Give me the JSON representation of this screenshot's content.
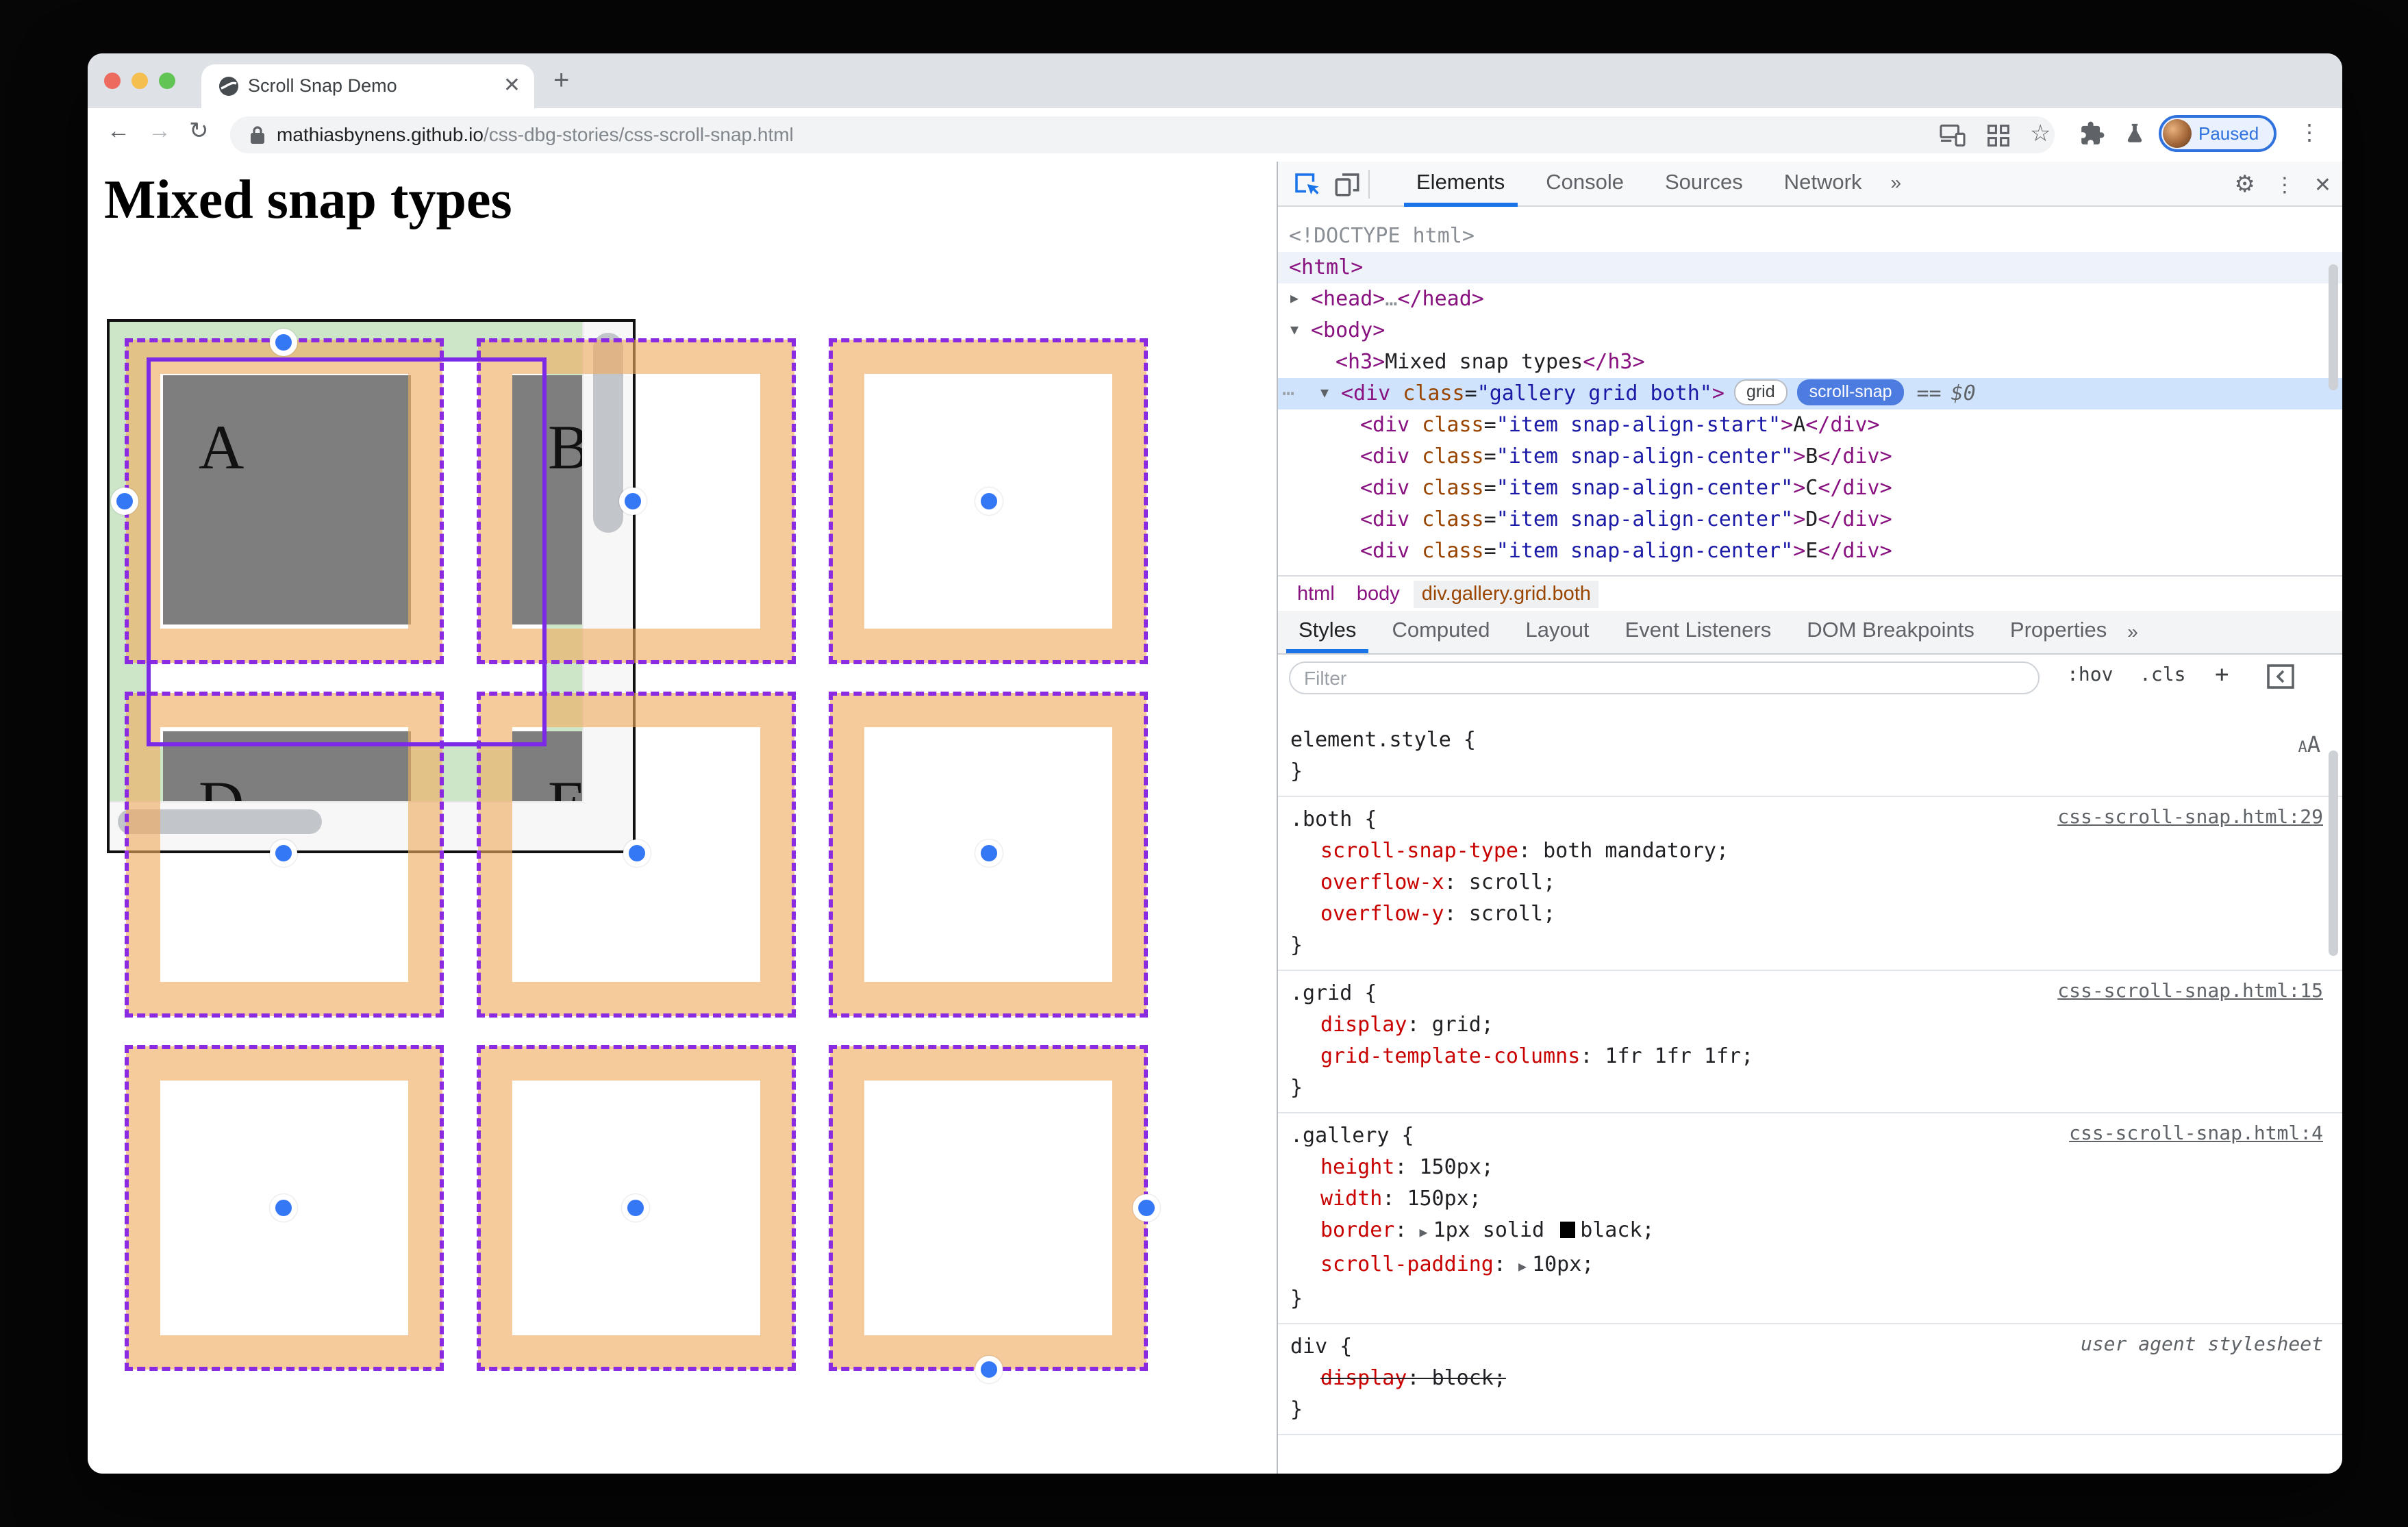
{
  "browser": {
    "tab_title": "Scroll Snap Demo",
    "new_tab_label": "+",
    "url": {
      "host": "mathiasbynens.github.io",
      "path": "/css-dbg-stories/css-scroll-snap.html"
    },
    "profile_badge": "Paused",
    "kebab": "⋮"
  },
  "page": {
    "heading": "Mixed snap types",
    "gallery_letters": [
      "A",
      "B",
      "D",
      "E"
    ]
  },
  "devtools": {
    "main_tabs": [
      "Elements",
      "Console",
      "Sources",
      "Network"
    ],
    "more_tabs_icon": "»",
    "gear_icon": "⚙",
    "kebab_icon": "⋮",
    "close_icon": "✕",
    "dom": {
      "lines": [
        {
          "ind": 8,
          "toks": [
            [
              "m",
              "<!DOCTYPE html>"
            ]
          ]
        },
        {
          "ind": 8,
          "soft": true,
          "toks": [
            [
              "t",
              "<html>"
            ]
          ]
        },
        {
          "ind": 24,
          "arrow": "▶",
          "toks": [
            [
              "t",
              "<head>"
            ],
            [
              "m",
              "…"
            ],
            [
              "t",
              "</head>"
            ]
          ]
        },
        {
          "ind": 24,
          "arrow": "▼",
          "toks": [
            [
              "t",
              "<body>"
            ]
          ]
        },
        {
          "ind": 42,
          "toks": [
            [
              "t",
              "<h3>"
            ],
            [
              "x",
              "Mixed snap types"
            ],
            [
              "t",
              "</h3>"
            ]
          ]
        },
        {
          "ind": 46,
          "arrow": "▼",
          "sel": true,
          "dots": "⋯",
          "badged": true,
          "toks": [
            [
              "t",
              "<div"
            ],
            [
              "a",
              " class"
            ],
            [
              "p",
              "="
            ],
            [
              "v",
              "\"gallery grid both\""
            ],
            [
              "t",
              ">"
            ]
          ]
        },
        {
          "ind": 60,
          "toks": [
            [
              "t",
              "<div"
            ],
            [
              "a",
              " class"
            ],
            [
              "p",
              "="
            ],
            [
              "v",
              "\"item snap-align-start\""
            ],
            [
              "t",
              ">"
            ],
            [
              "x",
              "A"
            ],
            [
              "t",
              "</div>"
            ]
          ]
        },
        {
          "ind": 60,
          "toks": [
            [
              "t",
              "<div"
            ],
            [
              "a",
              " class"
            ],
            [
              "p",
              "="
            ],
            [
              "v",
              "\"item snap-align-center\""
            ],
            [
              "t",
              ">"
            ],
            [
              "x",
              "B"
            ],
            [
              "t",
              "</div>"
            ]
          ]
        },
        {
          "ind": 60,
          "toks": [
            [
              "t",
              "<div"
            ],
            [
              "a",
              " class"
            ],
            [
              "p",
              "="
            ],
            [
              "v",
              "\"item snap-align-center\""
            ],
            [
              "t",
              ">"
            ],
            [
              "x",
              "C"
            ],
            [
              "t",
              "</div>"
            ]
          ]
        },
        {
          "ind": 60,
          "toks": [
            [
              "t",
              "<div"
            ],
            [
              "a",
              " class"
            ],
            [
              "p",
              "="
            ],
            [
              "v",
              "\"item snap-align-center\""
            ],
            [
              "t",
              ">"
            ],
            [
              "x",
              "D"
            ],
            [
              "t",
              "</div>"
            ]
          ]
        },
        {
          "ind": 60,
          "toks": [
            [
              "t",
              "<div"
            ],
            [
              "a",
              " class"
            ],
            [
              "p",
              "="
            ],
            [
              "v",
              "\"item snap-align-center\""
            ],
            [
              "t",
              ">"
            ],
            [
              "x",
              "E"
            ],
            [
              "t",
              "</div>"
            ]
          ]
        }
      ],
      "badges": [
        "grid",
        "scroll-snap"
      ],
      "suffix_eq": "==",
      "suffix_var": "$0"
    },
    "breadcrumb": [
      "html",
      "body",
      "div.gallery.grid.both"
    ],
    "styles_tabs": [
      "Styles",
      "Computed",
      "Layout",
      "Event Listeners",
      "DOM Breakpoints",
      "Properties"
    ],
    "filter_placeholder": "Filter",
    "hov_label": ":hov",
    "cls_label": ".cls",
    "add_label": "+",
    "font_size_label": "AA",
    "rules": [
      {
        "selector": "element.style",
        "link": "",
        "props": [],
        "aa": true
      },
      {
        "selector": ".both",
        "link": "css-scroll-snap.html:29",
        "props": [
          {
            "name": "scroll-snap-type",
            "value": "both mandatory"
          },
          {
            "name": "overflow-x",
            "value": "scroll"
          },
          {
            "name": "overflow-y",
            "value": "scroll"
          }
        ]
      },
      {
        "selector": ".grid",
        "link": "css-scroll-snap.html:15",
        "props": [
          {
            "name": "display",
            "value": "grid"
          },
          {
            "name": "grid-template-columns",
            "value": "1fr 1fr 1fr"
          }
        ]
      },
      {
        "selector": ".gallery",
        "link": "css-scroll-snap.html:4",
        "props": [
          {
            "name": "height",
            "value": "150px"
          },
          {
            "name": "width",
            "value": "150px"
          },
          {
            "name": "border",
            "arrow": true,
            "value_pre": "1px solid ",
            "swatch": "#000000",
            "value_post": "black"
          },
          {
            "name": "scroll-padding",
            "arrow": true,
            "value": "10px"
          }
        ]
      },
      {
        "selector": "div",
        "link": "user agent stylesheet",
        "ua": true,
        "props": [
          {
            "name": "display",
            "value": "block",
            "struck": true
          }
        ]
      }
    ]
  }
}
